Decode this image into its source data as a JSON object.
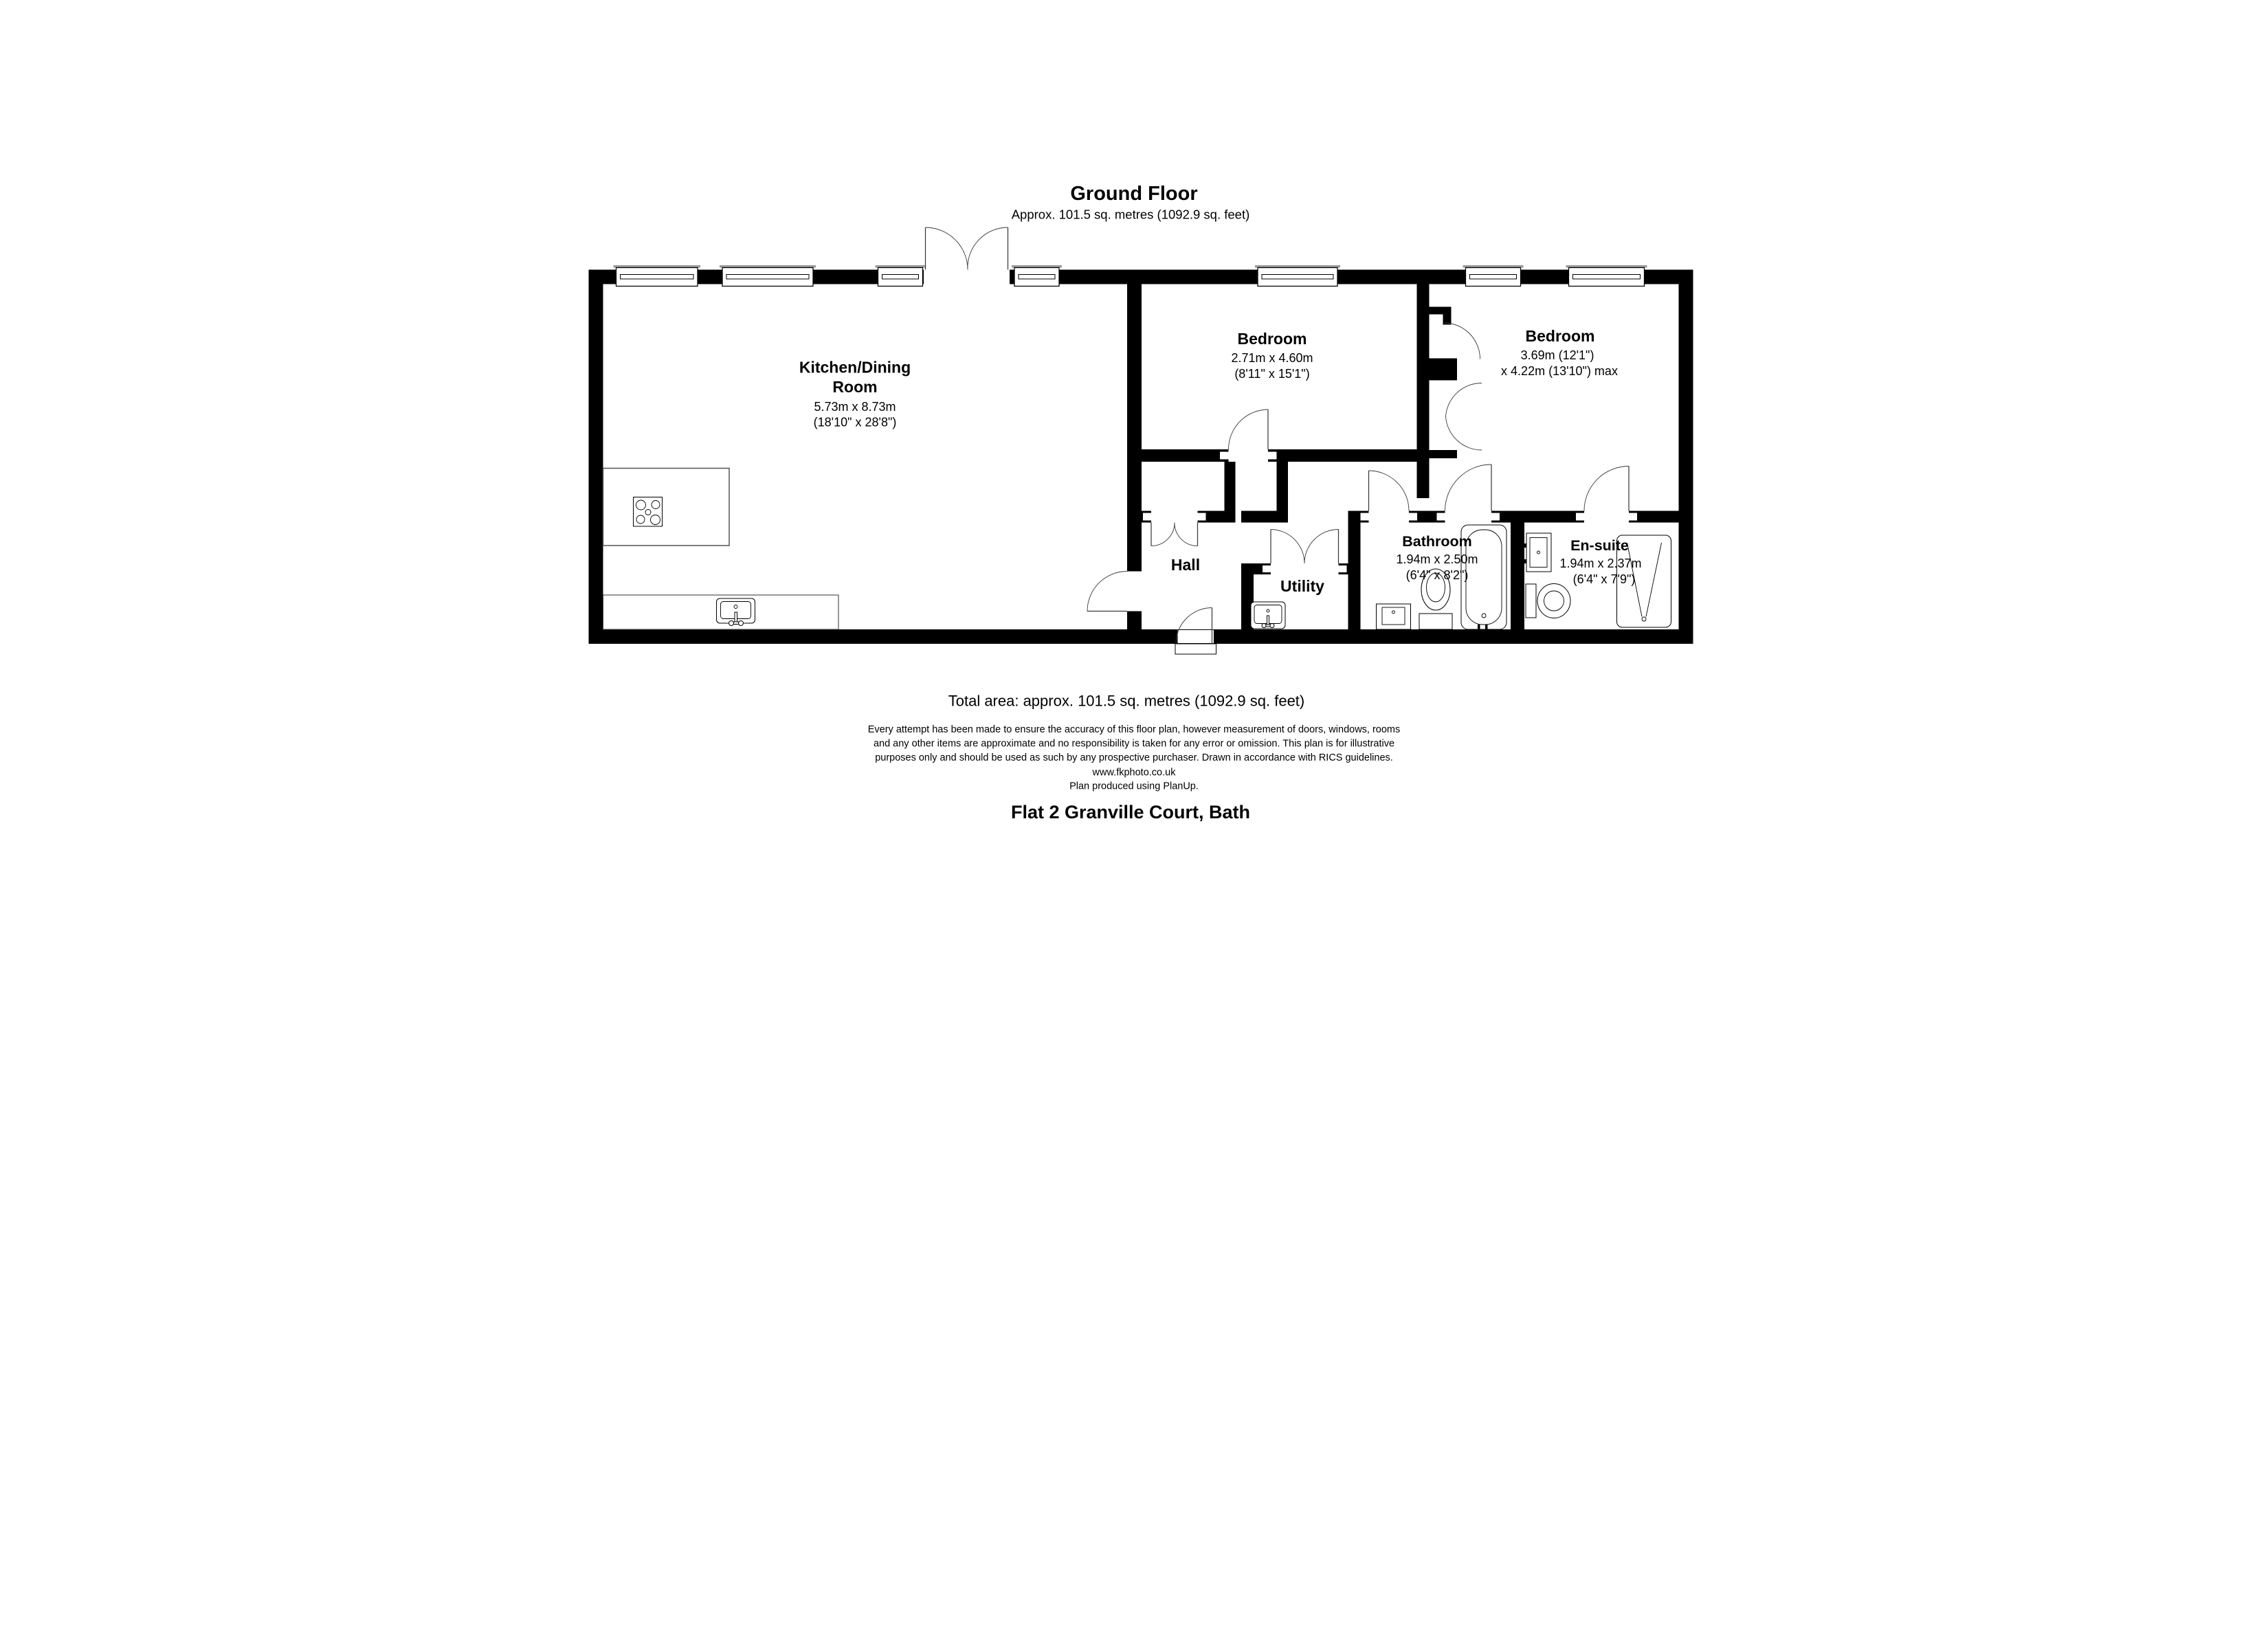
{
  "title": {
    "heading": "Ground Floor",
    "subtitle": "Approx. 101.5 sq. metres (1092.9 sq. feet)"
  },
  "rooms": {
    "kitchen": {
      "name_line1": "Kitchen/Dining",
      "name_line2": "Room",
      "dims_metric": "5.73m x 8.73m",
      "dims_imperial": "(18'10\" x 28'8\")"
    },
    "bedroom1": {
      "name": "Bedroom",
      "dims_metric": "2.71m x 4.60m",
      "dims_imperial": "(8'11\" x 15'1\")"
    },
    "bedroom2": {
      "name": "Bedroom",
      "dims_line1": "3.69m (12'1\")",
      "dims_line2": "x 4.22m (13'10\") max"
    },
    "hall": {
      "name": "Hall"
    },
    "utility": {
      "name": "Utility"
    },
    "bathroom": {
      "name": "Bathroom",
      "dims_metric": "1.94m x 2.50m",
      "dims_imperial": "(6'4\" x 8'2\")"
    },
    "ensuite": {
      "name": "En-suite",
      "dims_metric": "1.94m x 2.37m",
      "dims_imperial": "(6'4\" x 7'9\")"
    }
  },
  "footer": {
    "total_area": "Total area: approx. 101.5 sq. metres (1092.9 sq. feet)",
    "disclaimer_line1": "Every attempt has been made to ensure the accuracy of this floor plan, however measurement of doors, windows, rooms",
    "disclaimer_line2": "and any other items are approximate and no responsibility is taken for any error or omission. This plan is for illustrative",
    "disclaimer_line3": "purposes only and should be used as such by any prospective purchaser. Drawn in accordance with RICS guidelines.",
    "website": "www.fkphoto.co.uk",
    "produced": "Plan produced using PlanUp.",
    "address": "Flat 2 Granville Court, Bath"
  },
  "icons": {
    "hob": "hob-icon",
    "kitchen_sink": "sink-icon",
    "utility_sink": "sink-icon",
    "bathroom_basin": "basin-icon",
    "bathroom_toilet": "toilet-icon",
    "bath": "bathtub-icon",
    "ensuite_basin": "basin-icon",
    "ensuite_toilet": "toilet-icon",
    "shower": "shower-icon",
    "window": "window-icon",
    "door": "door-swing-icon"
  },
  "colors": {
    "wall": "#000000",
    "background": "#ffffff",
    "window_sill": "#9a9a9a"
  }
}
